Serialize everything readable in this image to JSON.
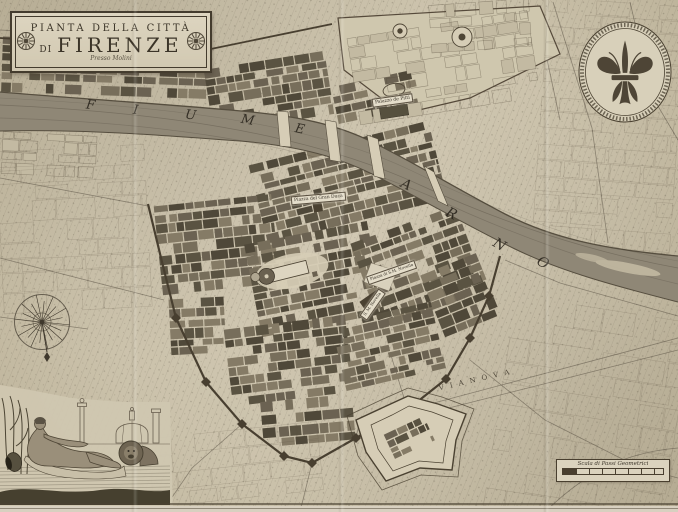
{
  "title": {
    "line1": "PIANTA DELLA CITTÀ",
    "line2_prefix": "DI",
    "line2": "FIRENZE",
    "imprint": "Presso Molini"
  },
  "river": {
    "fiume": [
      "F",
      "I",
      "U",
      "M",
      "E"
    ],
    "arno": [
      "A",
      "R",
      "N",
      "O"
    ]
  },
  "labels": {
    "palazzo_pitti": "Palazzo de Pitti",
    "piazza_gran_duca": "Piazza del Gran Duca",
    "piazza_sm_novella": "Piazza di S.M. Novella",
    "s_m_novella": "S. M. Novella",
    "via_nova": "V I A   N O V A",
    "scale_bar": "Scala di Passi Geometrici"
  },
  "icons": {
    "medallion": "florentine-lily",
    "compass": "compass-rose",
    "vignette": "river-god-arno-with-marzocco-lion"
  },
  "colors": {
    "paper": "#cdc4ae",
    "paper_light": "#d9d1bc",
    "ink": "#3e382c",
    "river": "#8f8776",
    "blocks": "#60584a"
  }
}
